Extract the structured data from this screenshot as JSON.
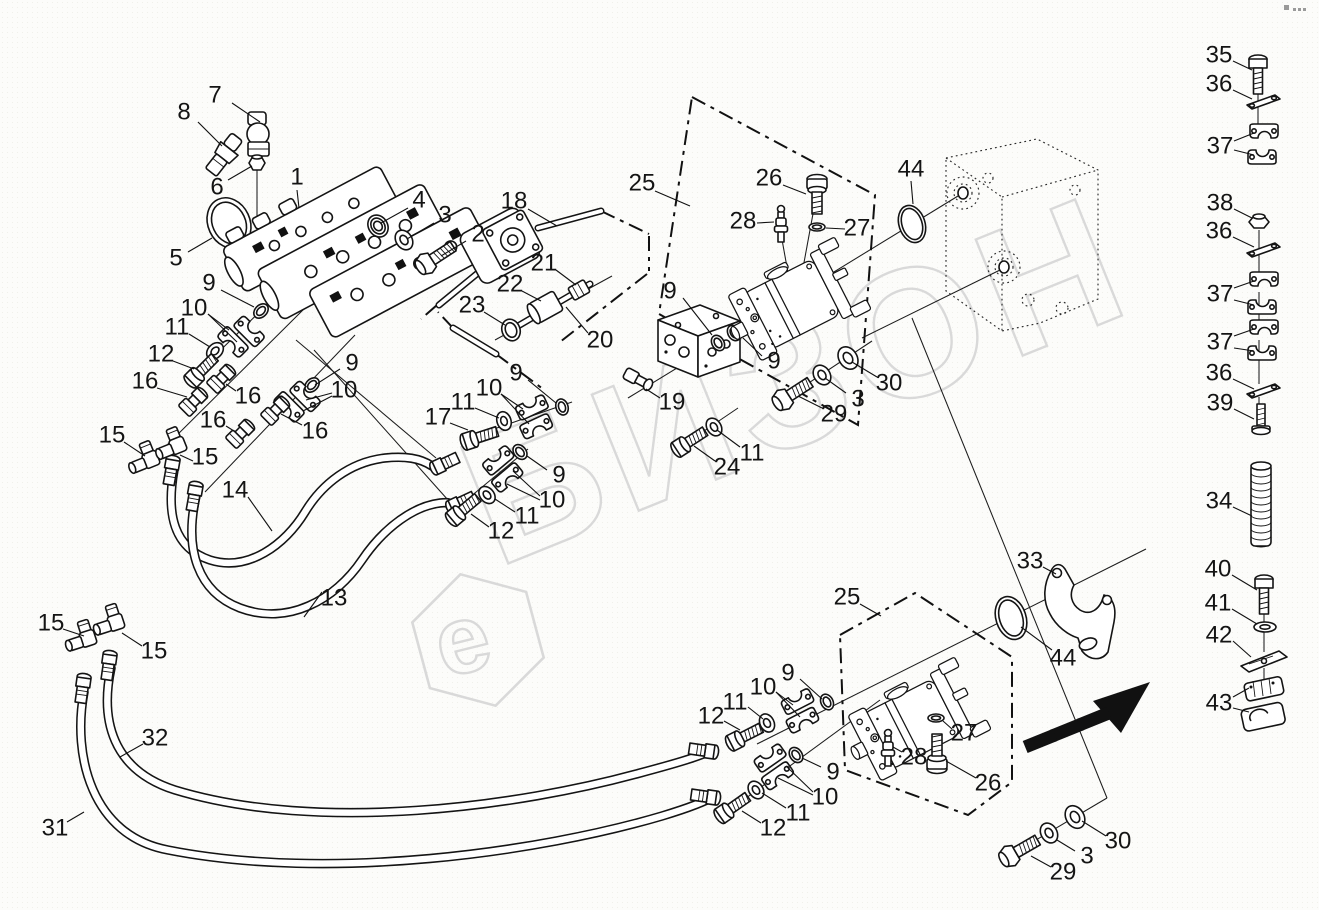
{
  "colors": {
    "line": "#141414",
    "watermark": "#d9d9d9"
  },
  "watermark": {
    "text": "БИЗОН"
  },
  "logo": {
    "letter": "e"
  },
  "callouts": [
    {
      "n": "7",
      "x": 215,
      "y": 95,
      "l": [
        [
          232,
          103,
          260,
          122
        ]
      ]
    },
    {
      "n": "8",
      "x": 184,
      "y": 112,
      "l": [
        [
          198,
          122,
          222,
          146
        ]
      ]
    },
    {
      "n": "6",
      "x": 217,
      "y": 187,
      "l": [
        [
          228,
          180,
          252,
          166
        ]
      ]
    },
    {
      "n": "1",
      "x": 297,
      "y": 177,
      "l": [
        [
          297,
          190,
          299,
          208
        ]
      ]
    },
    {
      "n": "5",
      "x": 176,
      "y": 258,
      "l": [
        [
          188,
          252,
          212,
          238
        ]
      ]
    },
    {
      "n": "4",
      "x": 419,
      "y": 200,
      "l": [
        [
          408,
          208,
          381,
          223
        ]
      ]
    },
    {
      "n": "3",
      "x": 445,
      "y": 215,
      "l": [
        [
          434,
          223,
          407,
          239
        ]
      ]
    },
    {
      "n": "2",
      "x": 478,
      "y": 234,
      "l": [
        [
          466,
          241,
          441,
          256
        ]
      ]
    },
    {
      "n": "18",
      "x": 514,
      "y": 201,
      "l": [
        [
          528,
          209,
          557,
          226
        ]
      ]
    },
    {
      "n": "9",
      "x": 209,
      "y": 283,
      "l": [
        [
          221,
          290,
          254,
          307
        ]
      ]
    },
    {
      "n": "10",
      "x": 194,
      "y": 308,
      "l": [
        [
          208,
          314,
          229,
          330
        ],
        [
          208,
          314,
          237,
          342
        ]
      ]
    },
    {
      "n": "11",
      "x": 177,
      "y": 327,
      "l": [
        [
          189,
          334,
          210,
          347
        ]
      ]
    },
    {
      "n": "12",
      "x": 161,
      "y": 354,
      "l": [
        [
          173,
          361,
          194,
          369
        ]
      ]
    },
    {
      "n": "16",
      "x": 145,
      "y": 381,
      "l": [
        [
          157,
          388,
          187,
          397
        ]
      ]
    },
    {
      "n": "16",
      "x": 248,
      "y": 396,
      "l": [
        [
          236,
          391,
          226,
          384
        ]
      ]
    },
    {
      "n": "16",
      "x": 213,
      "y": 420,
      "l": [
        [
          226,
          426,
          234,
          431
        ]
      ]
    },
    {
      "n": "16",
      "x": 315,
      "y": 431,
      "l": [
        [
          302,
          425,
          281,
          414
        ]
      ]
    },
    {
      "n": "15",
      "x": 112,
      "y": 435,
      "l": [
        [
          124,
          442,
          145,
          456
        ]
      ]
    },
    {
      "n": "15",
      "x": 205,
      "y": 457,
      "l": [
        [
          193,
          461,
          180,
          455
        ]
      ]
    },
    {
      "n": "9",
      "x": 352,
      "y": 363,
      "l": [
        [
          340,
          369,
          315,
          385
        ]
      ]
    },
    {
      "n": "10",
      "x": 344,
      "y": 390,
      "l": [
        [
          332,
          393,
          306,
          400
        ],
        [
          332,
          396,
          303,
          411
        ]
      ]
    },
    {
      "n": "14",
      "x": 235,
      "y": 490,
      "l": [
        [
          248,
          497,
          272,
          531
        ]
      ]
    },
    {
      "n": "13",
      "x": 334,
      "y": 598,
      "l": [
        [
          322,
          592,
          304,
          617
        ]
      ]
    },
    {
      "n": "17",
      "x": 438,
      "y": 417,
      "l": [
        [
          450,
          423,
          468,
          430
        ]
      ]
    },
    {
      "n": "11",
      "x": 463,
      "y": 402,
      "l": [
        [
          475,
          408,
          499,
          418
        ]
      ]
    },
    {
      "n": "10",
      "x": 489,
      "y": 388,
      "l": [
        [
          501,
          394,
          523,
          409
        ],
        [
          501,
          394,
          529,
          424
        ]
      ]
    },
    {
      "n": "9",
      "x": 516,
      "y": 373,
      "l": [
        [
          528,
          380,
          556,
          403
        ]
      ]
    },
    {
      "n": "9",
      "x": 559,
      "y": 475,
      "l": [
        [
          547,
          470,
          527,
          456
        ]
      ]
    },
    {
      "n": "10",
      "x": 552,
      "y": 500,
      "l": [
        [
          540,
          496,
          513,
          471
        ],
        [
          540,
          500,
          507,
          484
        ]
      ]
    },
    {
      "n": "11",
      "x": 527,
      "y": 516,
      "l": [
        [
          515,
          512,
          495,
          499
        ]
      ]
    },
    {
      "n": "12",
      "x": 501,
      "y": 531,
      "l": [
        [
          489,
          527,
          471,
          514
        ]
      ]
    },
    {
      "n": "21",
      "x": 544,
      "y": 263,
      "l": [
        [
          556,
          270,
          576,
          285
        ]
      ]
    },
    {
      "n": "22",
      "x": 510,
      "y": 284,
      "l": [
        [
          522,
          291,
          541,
          301
        ]
      ]
    },
    {
      "n": "23",
      "x": 472,
      "y": 305,
      "l": [
        [
          484,
          312,
          505,
          325
        ]
      ]
    },
    {
      "n": "20",
      "x": 600,
      "y": 340,
      "l": [
        [
          588,
          333,
          566,
          307
        ]
      ]
    },
    {
      "n": "25",
      "x": 642,
      "y": 183,
      "l": [
        [
          655,
          191,
          690,
          206
        ]
      ]
    },
    {
      "n": "26",
      "x": 769,
      "y": 178,
      "l": [
        [
          783,
          185,
          806,
          194
        ]
      ]
    },
    {
      "n": "28",
      "x": 743,
      "y": 221,
      "l": [
        [
          757,
          223,
          774,
          222
        ]
      ]
    },
    {
      "n": "27",
      "x": 857,
      "y": 228,
      "l": [
        [
          845,
          229,
          826,
          228
        ]
      ]
    },
    {
      "n": "44",
      "x": 911,
      "y": 169,
      "l": [
        [
          911,
          181,
          913,
          204
        ]
      ]
    },
    {
      "n": "9",
      "x": 670,
      "y": 291,
      "l": [
        [
          683,
          298,
          712,
          335
        ]
      ]
    },
    {
      "n": "9",
      "x": 774,
      "y": 361,
      "l": [
        [
          762,
          356,
          743,
          338
        ]
      ]
    },
    {
      "n": "19",
      "x": 672,
      "y": 402,
      "l": [
        [
          660,
          398,
          646,
          389
        ]
      ]
    },
    {
      "n": "24",
      "x": 727,
      "y": 467,
      "l": [
        [
          715,
          461,
          694,
          446
        ]
      ]
    },
    {
      "n": "11",
      "x": 752,
      "y": 453,
      "l": [
        [
          740,
          447,
          717,
          430
        ]
      ]
    },
    {
      "n": "29",
      "x": 834,
      "y": 414,
      "l": [
        [
          822,
          408,
          798,
          396
        ]
      ]
    },
    {
      "n": "3",
      "x": 858,
      "y": 399,
      "l": [
        [
          846,
          393,
          825,
          378
        ]
      ]
    },
    {
      "n": "30",
      "x": 889,
      "y": 383,
      "l": [
        [
          877,
          377,
          852,
          362
        ]
      ]
    },
    {
      "n": "44",
      "x": 1063,
      "y": 658,
      "l": [
        [
          1052,
          650,
          1021,
          627
        ]
      ]
    },
    {
      "n": "33",
      "x": 1030,
      "y": 561,
      "l": [
        [
          1043,
          567,
          1056,
          574
        ]
      ]
    },
    {
      "n": "25",
      "x": 847,
      "y": 597,
      "l": [
        [
          860,
          604,
          881,
          616
        ]
      ]
    },
    {
      "n": "27",
      "x": 964,
      "y": 733,
      "l": [
        [
          952,
          729,
          943,
          721
        ]
      ]
    },
    {
      "n": "28",
      "x": 914,
      "y": 757,
      "l": [
        [
          902,
          752,
          893,
          747
        ]
      ]
    },
    {
      "n": "26",
      "x": 988,
      "y": 783,
      "l": [
        [
          976,
          778,
          946,
          761
        ]
      ]
    },
    {
      "n": "9",
      "x": 788,
      "y": 673,
      "l": [
        [
          800,
          679,
          822,
          699
        ]
      ]
    },
    {
      "n": "10",
      "x": 763,
      "y": 687,
      "l": [
        [
          776,
          692,
          793,
          705
        ],
        [
          776,
          692,
          800,
          717
        ]
      ]
    },
    {
      "n": "11",
      "x": 735,
      "y": 702,
      "l": [
        [
          748,
          707,
          763,
          719
        ]
      ]
    },
    {
      "n": "12",
      "x": 711,
      "y": 716,
      "l": [
        [
          724,
          721,
          740,
          730
        ]
      ]
    },
    {
      "n": "9",
      "x": 833,
      "y": 772,
      "l": [
        [
          821,
          767,
          802,
          758
        ]
      ]
    },
    {
      "n": "10",
      "x": 825,
      "y": 797,
      "l": [
        [
          813,
          792,
          786,
          766
        ],
        [
          813,
          795,
          778,
          778
        ]
      ]
    },
    {
      "n": "11",
      "x": 798,
      "y": 813,
      "l": [
        [
          786,
          808,
          762,
          793
        ]
      ]
    },
    {
      "n": "12",
      "x": 773,
      "y": 828,
      "l": [
        [
          761,
          823,
          742,
          811
        ]
      ]
    },
    {
      "n": "30",
      "x": 1118,
      "y": 841,
      "l": [
        [
          1106,
          836,
          1082,
          821
        ]
      ]
    },
    {
      "n": "3",
      "x": 1087,
      "y": 856,
      "l": [
        [
          1075,
          851,
          1057,
          840
        ]
      ]
    },
    {
      "n": "29",
      "x": 1063,
      "y": 872,
      "l": [
        [
          1051,
          867,
          1031,
          856
        ]
      ]
    },
    {
      "n": "15",
      "x": 51,
      "y": 623,
      "l": [
        [
          63,
          629,
          84,
          636
        ]
      ]
    },
    {
      "n": "15",
      "x": 154,
      "y": 651,
      "l": [
        [
          142,
          646,
          122,
          633
        ]
      ]
    },
    {
      "n": "32",
      "x": 155,
      "y": 738,
      "l": [
        [
          143,
          744,
          120,
          757
        ]
      ]
    },
    {
      "n": "31",
      "x": 55,
      "y": 828,
      "l": [
        [
          67,
          822,
          84,
          812
        ]
      ]
    },
    {
      "n": "35",
      "x": 1219,
      "y": 55,
      "l": [
        [
          1233,
          61,
          1252,
          70
        ]
      ]
    },
    {
      "n": "36",
      "x": 1219,
      "y": 84,
      "l": [
        [
          1233,
          90,
          1252,
          99
        ]
      ]
    },
    {
      "n": "37",
      "x": 1220,
      "y": 146,
      "l": [
        [
          1234,
          141,
          1254,
          133
        ],
        [
          1234,
          150,
          1254,
          155
        ]
      ]
    },
    {
      "n": "38",
      "x": 1220,
      "y": 203,
      "l": [
        [
          1234,
          209,
          1252,
          218
        ]
      ]
    },
    {
      "n": "36",
      "x": 1219,
      "y": 231,
      "l": [
        [
          1233,
          237,
          1254,
          247
        ]
      ]
    },
    {
      "n": "37",
      "x": 1220,
      "y": 294,
      "l": [
        [
          1234,
          288,
          1254,
          281
        ],
        [
          1234,
          300,
          1254,
          305
        ]
      ]
    },
    {
      "n": "37",
      "x": 1220,
      "y": 342,
      "l": [
        [
          1234,
          336,
          1254,
          329
        ],
        [
          1234,
          348,
          1254,
          351
        ]
      ]
    },
    {
      "n": "36",
      "x": 1219,
      "y": 373,
      "l": [
        [
          1233,
          379,
          1254,
          389
        ]
      ]
    },
    {
      "n": "39",
      "x": 1220,
      "y": 403,
      "l": [
        [
          1234,
          409,
          1254,
          419
        ]
      ]
    },
    {
      "n": "34",
      "x": 1219,
      "y": 501,
      "l": [
        [
          1233,
          507,
          1252,
          516
        ]
      ]
    },
    {
      "n": "40",
      "x": 1218,
      "y": 569,
      "l": [
        [
          1232,
          575,
          1257,
          590
        ]
      ]
    },
    {
      "n": "41",
      "x": 1218,
      "y": 603,
      "l": [
        [
          1232,
          609,
          1257,
          624
        ]
      ]
    },
    {
      "n": "42",
      "x": 1219,
      "y": 635,
      "l": [
        [
          1233,
          641,
          1251,
          657
        ]
      ]
    },
    {
      "n": "43",
      "x": 1219,
      "y": 703,
      "l": [
        [
          1233,
          697,
          1249,
          688
        ],
        [
          1233,
          708,
          1249,
          712
        ]
      ]
    }
  ]
}
